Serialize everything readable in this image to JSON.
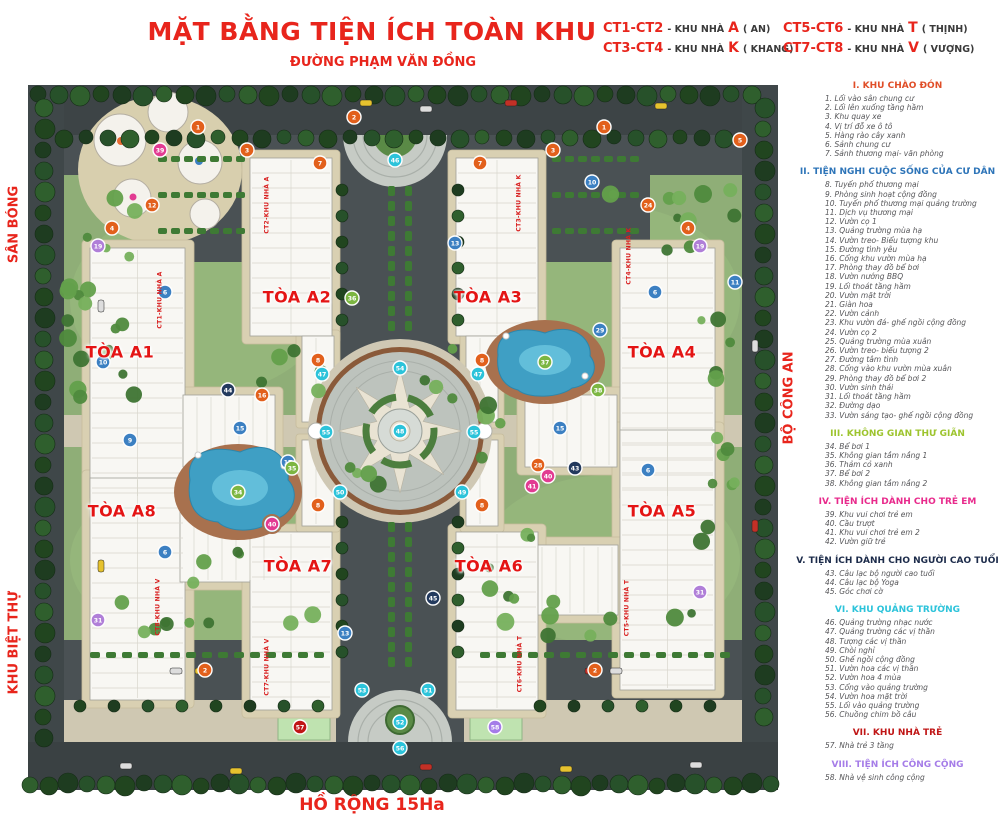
{
  "title": "MẶT BẰNG TIỆN ÍCH TOÀN KHU",
  "streets": {
    "top": "ĐƯỜNG PHẠM VĂN ĐỒNG",
    "left_top": "SÂN BÓNG",
    "left_bottom": "KHU BIỆT THỰ",
    "right": "BỘ CÔNG AN",
    "bottom": "HỒ RỘNG 15Ha"
  },
  "building_key": [
    {
      "code": "CT1-CT2",
      "prefix": "- KHU NHÀ",
      "letter": "A",
      "name": "( AN)"
    },
    {
      "code": "CT3-CT4",
      "prefix": "- KHU NHÀ",
      "letter": "K",
      "name": "( KHANG)"
    },
    {
      "code": "CT5-CT6",
      "prefix": "- KHU NHÀ",
      "letter": "T",
      "name": "( THỊNH)"
    },
    {
      "code": "CT7-CT8",
      "prefix": "- KHU NHÀ",
      "letter": "V",
      "name": "( VƯỢNG)"
    }
  ],
  "towers": [
    {
      "id": "A1",
      "label": "TÒA A1",
      "ct": "CT1-KHU NHÀ A"
    },
    {
      "id": "A2",
      "label": "TÒA A2",
      "ct": "CT2-KHU NHÀ A"
    },
    {
      "id": "A3",
      "label": "TÒA A3",
      "ct": "CT3-KHU NHÀ K"
    },
    {
      "id": "A4",
      "label": "TÒA A4",
      "ct": "CT4-KHU NHÀ K"
    },
    {
      "id": "A5",
      "label": "TÒA A5",
      "ct": "CT5-KHU NHÀ T"
    },
    {
      "id": "A6",
      "label": "TÒA A6",
      "ct": "CT6-KHU NHÀ T"
    },
    {
      "id": "A7",
      "label": "TÒA A7",
      "ct": "CT7-KHU NHÀ V"
    },
    {
      "id": "A8",
      "label": "TÒA A8",
      "ct": "CT8-KHU NHÀ V"
    }
  ],
  "legend_sections": [
    {
      "header": "I. KHU CHÀO ĐÓN",
      "color": "#e04e28",
      "items": [
        {
          "n": 1,
          "text": "Lối vào sân chung cư"
        },
        {
          "n": 2,
          "text": "Lối lên xuống tầng hầm"
        },
        {
          "n": 3,
          "text": "Khu quay xe"
        },
        {
          "n": 4,
          "text": "Vị trí đỗ xe ô tô"
        },
        {
          "n": 5,
          "text": "Hàng rào cây xanh"
        },
        {
          "n": 6,
          "text": "Sảnh chung cư"
        },
        {
          "n": 7,
          "text": "Sảnh thương mại- văn phòng"
        }
      ]
    },
    {
      "header": "II. TIỆN NGHI CUỘC SỐNG CỦA CƯ DÂN",
      "color": "#2d74b8",
      "items": [
        {
          "n": 8,
          "text": "Tuyến phố thương mại"
        },
        {
          "n": 9,
          "text": "Phòng sinh hoạt cộng đồng"
        },
        {
          "n": 10,
          "text": "Tuyến phố thương mại quảng trường"
        },
        {
          "n": 11,
          "text": "Dịch vụ thương mại"
        },
        {
          "n": 12,
          "text": "Vườn cọ 1"
        },
        {
          "n": 13,
          "text": "Quảng trường mùa hạ"
        },
        {
          "n": 14,
          "text": "Vườn treo- Biểu tượng khu"
        },
        {
          "n": 15,
          "text": "Đường tình yêu"
        },
        {
          "n": 16,
          "text": "Cổng khu vườn mùa hạ"
        },
        {
          "n": 17,
          "text": "Phòng thay đồ bể bơi"
        },
        {
          "n": 18,
          "text": "Vườn nướng BBQ"
        },
        {
          "n": 19,
          "text": "Lối thoát tầng hầm"
        },
        {
          "n": 20,
          "text": "Vườn mặt trời"
        },
        {
          "n": 21,
          "text": "Giàn hoa"
        },
        {
          "n": 22,
          "text": "Vườn cảnh"
        },
        {
          "n": 23,
          "text": "Khu vườn đá- ghế ngồi cộng đồng"
        },
        {
          "n": 24,
          "text": "Vườn cọ 2"
        },
        {
          "n": 25,
          "text": "Quảng trường mùa xuân"
        },
        {
          "n": 26,
          "text": "Vườn treo- biểu tượng 2"
        },
        {
          "n": 27,
          "text": "Đường tâm tình"
        },
        {
          "n": 28,
          "text": "Cổng vào khu vườn mùa xuân"
        },
        {
          "n": 29,
          "text": "Phòng thay đồ bể bơi 2"
        },
        {
          "n": 30,
          "text": "Vườn sinh thái"
        },
        {
          "n": 31,
          "text": "Lối thoát tầng hầm"
        },
        {
          "n": 32,
          "text": "Đường dạo"
        },
        {
          "n": 33,
          "text": "Vườn sáng tạo- ghế ngồi cộng đồng"
        }
      ]
    },
    {
      "header": "III. KHÔNG GIAN THƯ GIÃN",
      "color": "#9dc42e",
      "items": [
        {
          "n": 34,
          "text": "Bể bơi 1"
        },
        {
          "n": 35,
          "text": "Không gian tắm nắng 1"
        },
        {
          "n": 36,
          "text": "Thảm cỏ xanh"
        },
        {
          "n": 37,
          "text": "Bể bơi 2"
        },
        {
          "n": 38,
          "text": "Không gian tắm nắng 2"
        }
      ]
    },
    {
      "header": "IV. TIỆN ÍCH DÀNH CHO TRẺ EM",
      "color": "#e82a8c",
      "items": [
        {
          "n": 39,
          "text": "Khu vui chơi trẻ em"
        },
        {
          "n": 40,
          "text": "Cầu trượt"
        },
        {
          "n": 41,
          "text": "Khu vui chơi trẻ em 2"
        },
        {
          "n": 42,
          "text": "Vườn giữ trẻ"
        }
      ]
    },
    {
      "header": "V. TIỆN ÍCH DÀNH CHO NGƯỜI CAO TUỔI",
      "color": "#1c2b4a",
      "items": [
        {
          "n": 43,
          "text": "Câu lạc bộ người cao tuổi"
        },
        {
          "n": 44,
          "text": "Câu lạc bộ Yoga"
        },
        {
          "n": 45,
          "text": "Góc chơi cờ"
        }
      ]
    },
    {
      "header": "VI. KHU QUẢNG TRƯỜNG",
      "color": "#2cc3da",
      "items": [
        {
          "n": 46,
          "text": "Quảng trường nhạc nước"
        },
        {
          "n": 47,
          "text": "Quảng trường các vị thần"
        },
        {
          "n": 48,
          "text": "Tượng các vị thần"
        },
        {
          "n": 49,
          "text": "Chòi nghỉ"
        },
        {
          "n": 50,
          "text": "Ghế ngồi cộng đồng"
        },
        {
          "n": 51,
          "text": "Vườn hoa các vị thần"
        },
        {
          "n": 52,
          "text": "Vườn hoa 4 mùa"
        },
        {
          "n": 53,
          "text": "Cổng vào quảng trường"
        },
        {
          "n": 54,
          "text": "Vườn hoa mặt trời"
        },
        {
          "n": 55,
          "text": "Lối vào quảng trường"
        },
        {
          "n": 56,
          "text": "Chuồng chim bồ câu"
        }
      ]
    },
    {
      "header": "VII. KHU NHÀ TRẺ",
      "color": "#c01616",
      "items": [
        {
          "n": 57,
          "text": "Nhà trẻ 3 tầng"
        }
      ]
    },
    {
      "header": "VIII. TIỆN ÍCH CÔNG CỘNG",
      "color": "#a57ce8",
      "items": [
        {
          "n": 58,
          "text": "Nhà vệ sinh công cộng"
        }
      ]
    }
  ],
  "marker_colors": {
    "o": "#e2601c",
    "b": "#3c80c2",
    "p": "#b07fd8",
    "g": "#7cb642",
    "pk": "#e23b92",
    "n": "#233a5e",
    "c": "#2cc3da",
    "r": "#c01616",
    "v8": "#a57ce8"
  },
  "markers": [
    {
      "n": "1",
      "c": "o",
      "x": 198,
      "y": 127
    },
    {
      "n": "2",
      "c": "o",
      "x": 354,
      "y": 117
    },
    {
      "n": "3",
      "c": "o",
      "x": 247,
      "y": 150
    },
    {
      "n": "7",
      "c": "o",
      "x": 320,
      "y": 163
    },
    {
      "n": "1",
      "c": "o",
      "x": 604,
      "y": 127
    },
    {
      "n": "3",
      "c": "o",
      "x": 553,
      "y": 150
    },
    {
      "n": "7",
      "c": "o",
      "x": 480,
      "y": 163
    },
    {
      "n": "4",
      "c": "o",
      "x": 112,
      "y": 228
    },
    {
      "n": "4",
      "c": "o",
      "x": 688,
      "y": 228
    },
    {
      "n": "12",
      "c": "o",
      "x": 152,
      "y": 205
    },
    {
      "n": "24",
      "c": "o",
      "x": 648,
      "y": 205
    },
    {
      "n": "8",
      "c": "o",
      "x": 318,
      "y": 360
    },
    {
      "n": "8",
      "c": "o",
      "x": 482,
      "y": 360
    },
    {
      "n": "8",
      "c": "o",
      "x": 318,
      "y": 505
    },
    {
      "n": "8",
      "c": "o",
      "x": 482,
      "y": 505
    },
    {
      "n": "2",
      "c": "o",
      "x": 205,
      "y": 670
    },
    {
      "n": "2",
      "c": "o",
      "x": 595,
      "y": 670
    },
    {
      "n": "5",
      "c": "o",
      "x": 740,
      "y": 140
    },
    {
      "n": "16",
      "c": "o",
      "x": 262,
      "y": 395
    },
    {
      "n": "28",
      "c": "o",
      "x": 538,
      "y": 465
    },
    {
      "n": "6",
      "c": "b",
      "x": 165,
      "y": 292
    },
    {
      "n": "6",
      "c": "b",
      "x": 655,
      "y": 292
    },
    {
      "n": "6",
      "c": "b",
      "x": 165,
      "y": 552
    },
    {
      "n": "6",
      "c": "b",
      "x": 648,
      "y": 470
    },
    {
      "n": "9",
      "c": "b",
      "x": 130,
      "y": 440
    },
    {
      "n": "10",
      "c": "b",
      "x": 103,
      "y": 362
    },
    {
      "n": "10",
      "c": "b",
      "x": 592,
      "y": 182
    },
    {
      "n": "11",
      "c": "b",
      "x": 735,
      "y": 282
    },
    {
      "n": "13",
      "c": "b",
      "x": 455,
      "y": 243
    },
    {
      "n": "13",
      "c": "b",
      "x": 345,
      "y": 633
    },
    {
      "n": "15",
      "c": "b",
      "x": 240,
      "y": 428
    },
    {
      "n": "15",
      "c": "b",
      "x": 560,
      "y": 428
    },
    {
      "n": "17",
      "c": "b",
      "x": 288,
      "y": 462
    },
    {
      "n": "29",
      "c": "b",
      "x": 600,
      "y": 330
    },
    {
      "n": "19",
      "c": "p",
      "x": 98,
      "y": 246
    },
    {
      "n": "19",
      "c": "p",
      "x": 700,
      "y": 246
    },
    {
      "n": "31",
      "c": "p",
      "x": 98,
      "y": 620
    },
    {
      "n": "31",
      "c": "p",
      "x": 700,
      "y": 592
    },
    {
      "n": "58",
      "c": "v8",
      "x": 495,
      "y": 727
    },
    {
      "n": "34",
      "c": "g",
      "x": 238,
      "y": 492
    },
    {
      "n": "35",
      "c": "g",
      "x": 292,
      "y": 468
    },
    {
      "n": "37",
      "c": "g",
      "x": 545,
      "y": 362
    },
    {
      "n": "38",
      "c": "g",
      "x": 598,
      "y": 390
    },
    {
      "n": "36",
      "c": "g",
      "x": 352,
      "y": 298
    },
    {
      "n": "39",
      "c": "pk",
      "x": 160,
      "y": 150
    },
    {
      "n": "40",
      "c": "pk",
      "x": 272,
      "y": 524
    },
    {
      "n": "41",
      "c": "pk",
      "x": 532,
      "y": 486
    },
    {
      "n": "40",
      "c": "pk",
      "x": 548,
      "y": 476
    },
    {
      "n": "43",
      "c": "n",
      "x": 575,
      "y": 468
    },
    {
      "n": "44",
      "c": "n",
      "x": 228,
      "y": 390
    },
    {
      "n": "45",
      "c": "n",
      "x": 433,
      "y": 598
    },
    {
      "n": "46",
      "c": "c",
      "x": 395,
      "y": 160
    },
    {
      "n": "47",
      "c": "c",
      "x": 322,
      "y": 374
    },
    {
      "n": "47",
      "c": "c",
      "x": 478,
      "y": 374
    },
    {
      "n": "48",
      "c": "c",
      "x": 400,
      "y": 431
    },
    {
      "n": "54",
      "c": "c",
      "x": 400,
      "y": 368
    },
    {
      "n": "55",
      "c": "c",
      "x": 326,
      "y": 432
    },
    {
      "n": "55",
      "c": "c",
      "x": 474,
      "y": 432
    },
    {
      "n": "50",
      "c": "c",
      "x": 340,
      "y": 492
    },
    {
      "n": "49",
      "c": "c",
      "x": 462,
      "y": 492
    },
    {
      "n": "53",
      "c": "c",
      "x": 362,
      "y": 690
    },
    {
      "n": "51",
      "c": "c",
      "x": 428,
      "y": 690
    },
    {
      "n": "52",
      "c": "c",
      "x": 400,
      "y": 722
    },
    {
      "n": "56",
      "c": "c",
      "x": 400,
      "y": 748
    },
    {
      "n": "57",
      "c": "r",
      "x": 300,
      "y": 727
    }
  ]
}
